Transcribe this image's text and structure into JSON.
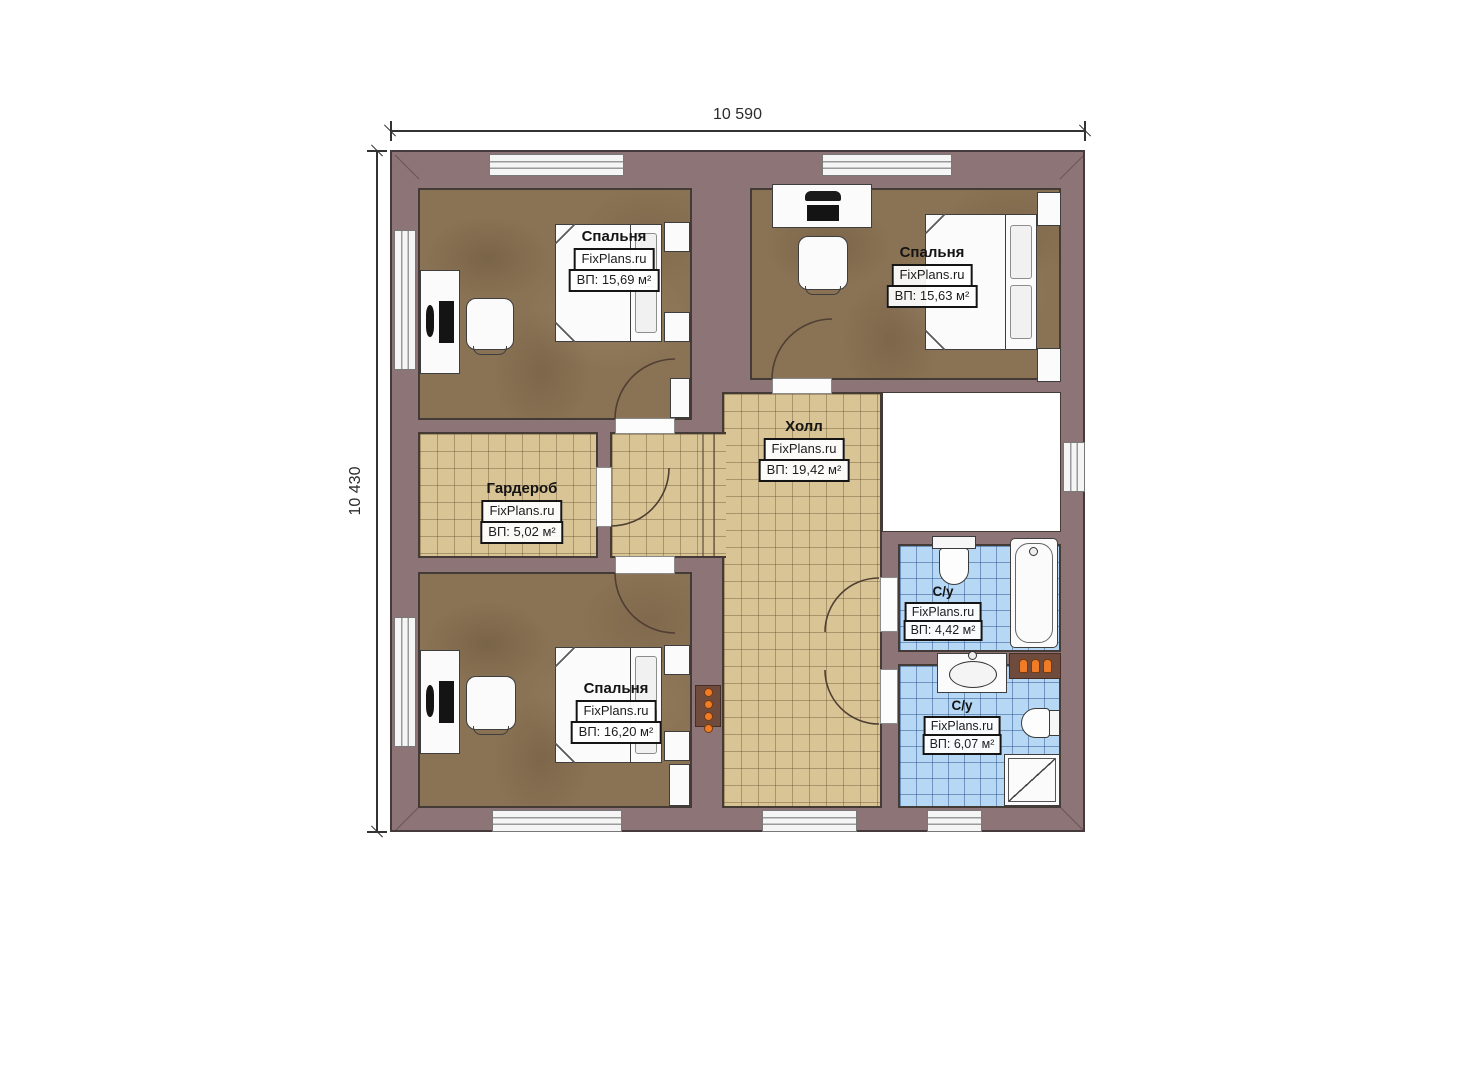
{
  "plan": {
    "dim_width": "10 590",
    "dim_height": "10 430",
    "watermark": "FixPlans.ru",
    "rooms": {
      "bedroom_tl": {
        "name": "Спальня",
        "area": "ВП: 15,69 м²"
      },
      "bedroom_tr": {
        "name": "Спальня",
        "area": "ВП: 15,63 м²"
      },
      "hall": {
        "name": "Холл",
        "area": "ВП: 19,42 м²"
      },
      "wardrobe": {
        "name": "Гардероб",
        "area": "ВП: 5,02 м²"
      },
      "bedroom_bottom": {
        "name": "Спальня",
        "area": "ВП: 16,20 м²"
      },
      "bathroom_top": {
        "name": "С/у",
        "area": "ВП: 4,42 м²"
      },
      "bathroom_bottom": {
        "name": "С/у",
        "area": "ВП: 6,07 м²"
      }
    },
    "colors": {
      "wall": "#8c7477",
      "wood_floor": "#8a7254",
      "tile_floor": "#d9c495",
      "bath_tile": "#b7d8f4",
      "accent_orange": "#f07c28"
    }
  }
}
